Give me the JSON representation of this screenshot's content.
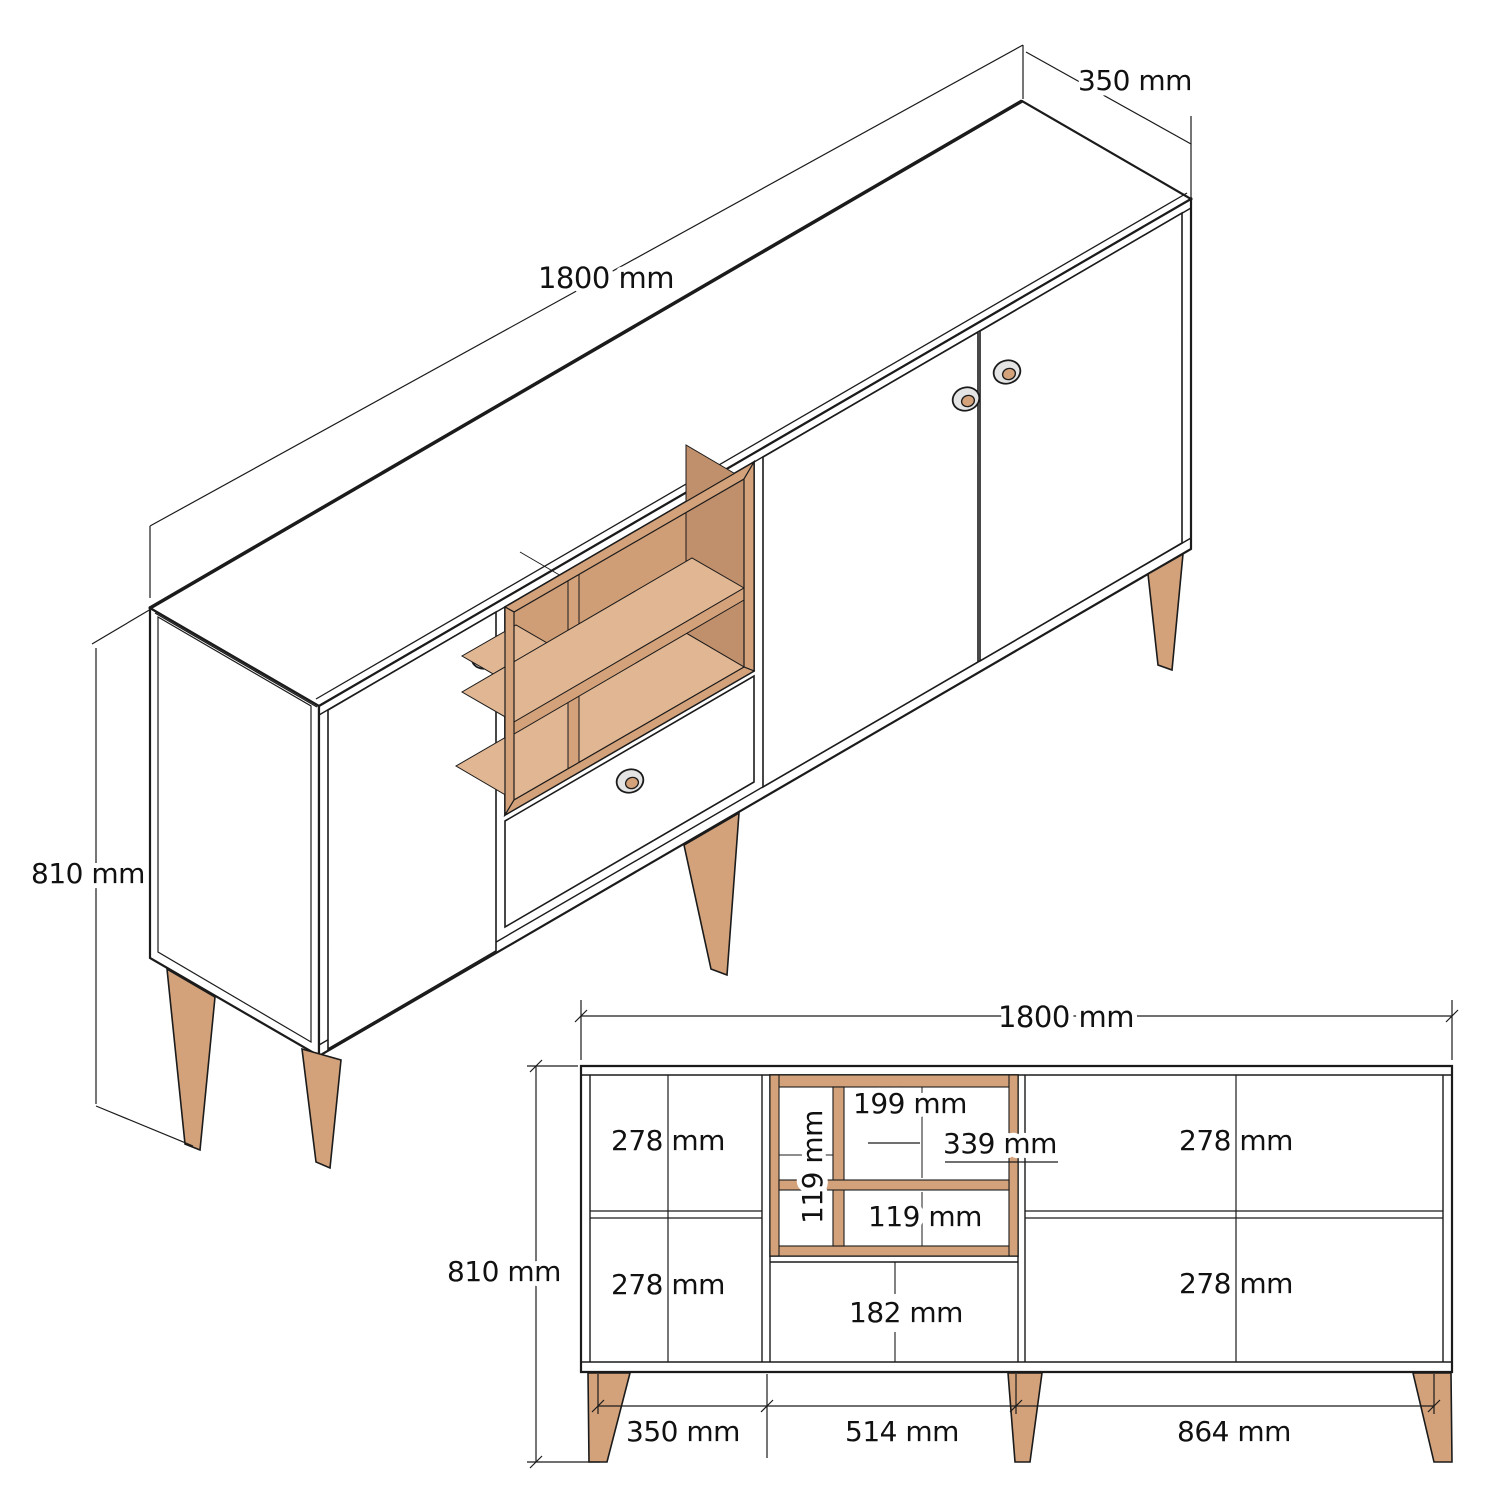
{
  "colors": {
    "wood": "#d3a27b",
    "wood_light": "#e0b693",
    "wood_dark": "#c08f6b",
    "wood_back": "#cf9d76",
    "knob_outer": "#e4e4e4",
    "line": "#1b1b1b",
    "background": "#ffffff"
  },
  "isometric_view": {
    "length_label": "1800 mm",
    "depth_label": "350 mm",
    "height_label": "810 mm"
  },
  "front_view": {
    "width_label": "1800 mm",
    "height_label": "810 mm",
    "left_top_label": "278 mm",
    "left_bottom_label": "278 mm",
    "right_top_label": "278 mm",
    "right_bottom_label": "278 mm",
    "niche_top_width_label": "199 mm",
    "niche_right_width_label": "339 mm",
    "niche_column_label": "119 mm",
    "niche_bottom_label": "119 mm",
    "drawer_label": "182 mm",
    "bottom_left_label": "350 mm",
    "bottom_center_label": "514 mm",
    "bottom_right_label": "864 mm"
  }
}
